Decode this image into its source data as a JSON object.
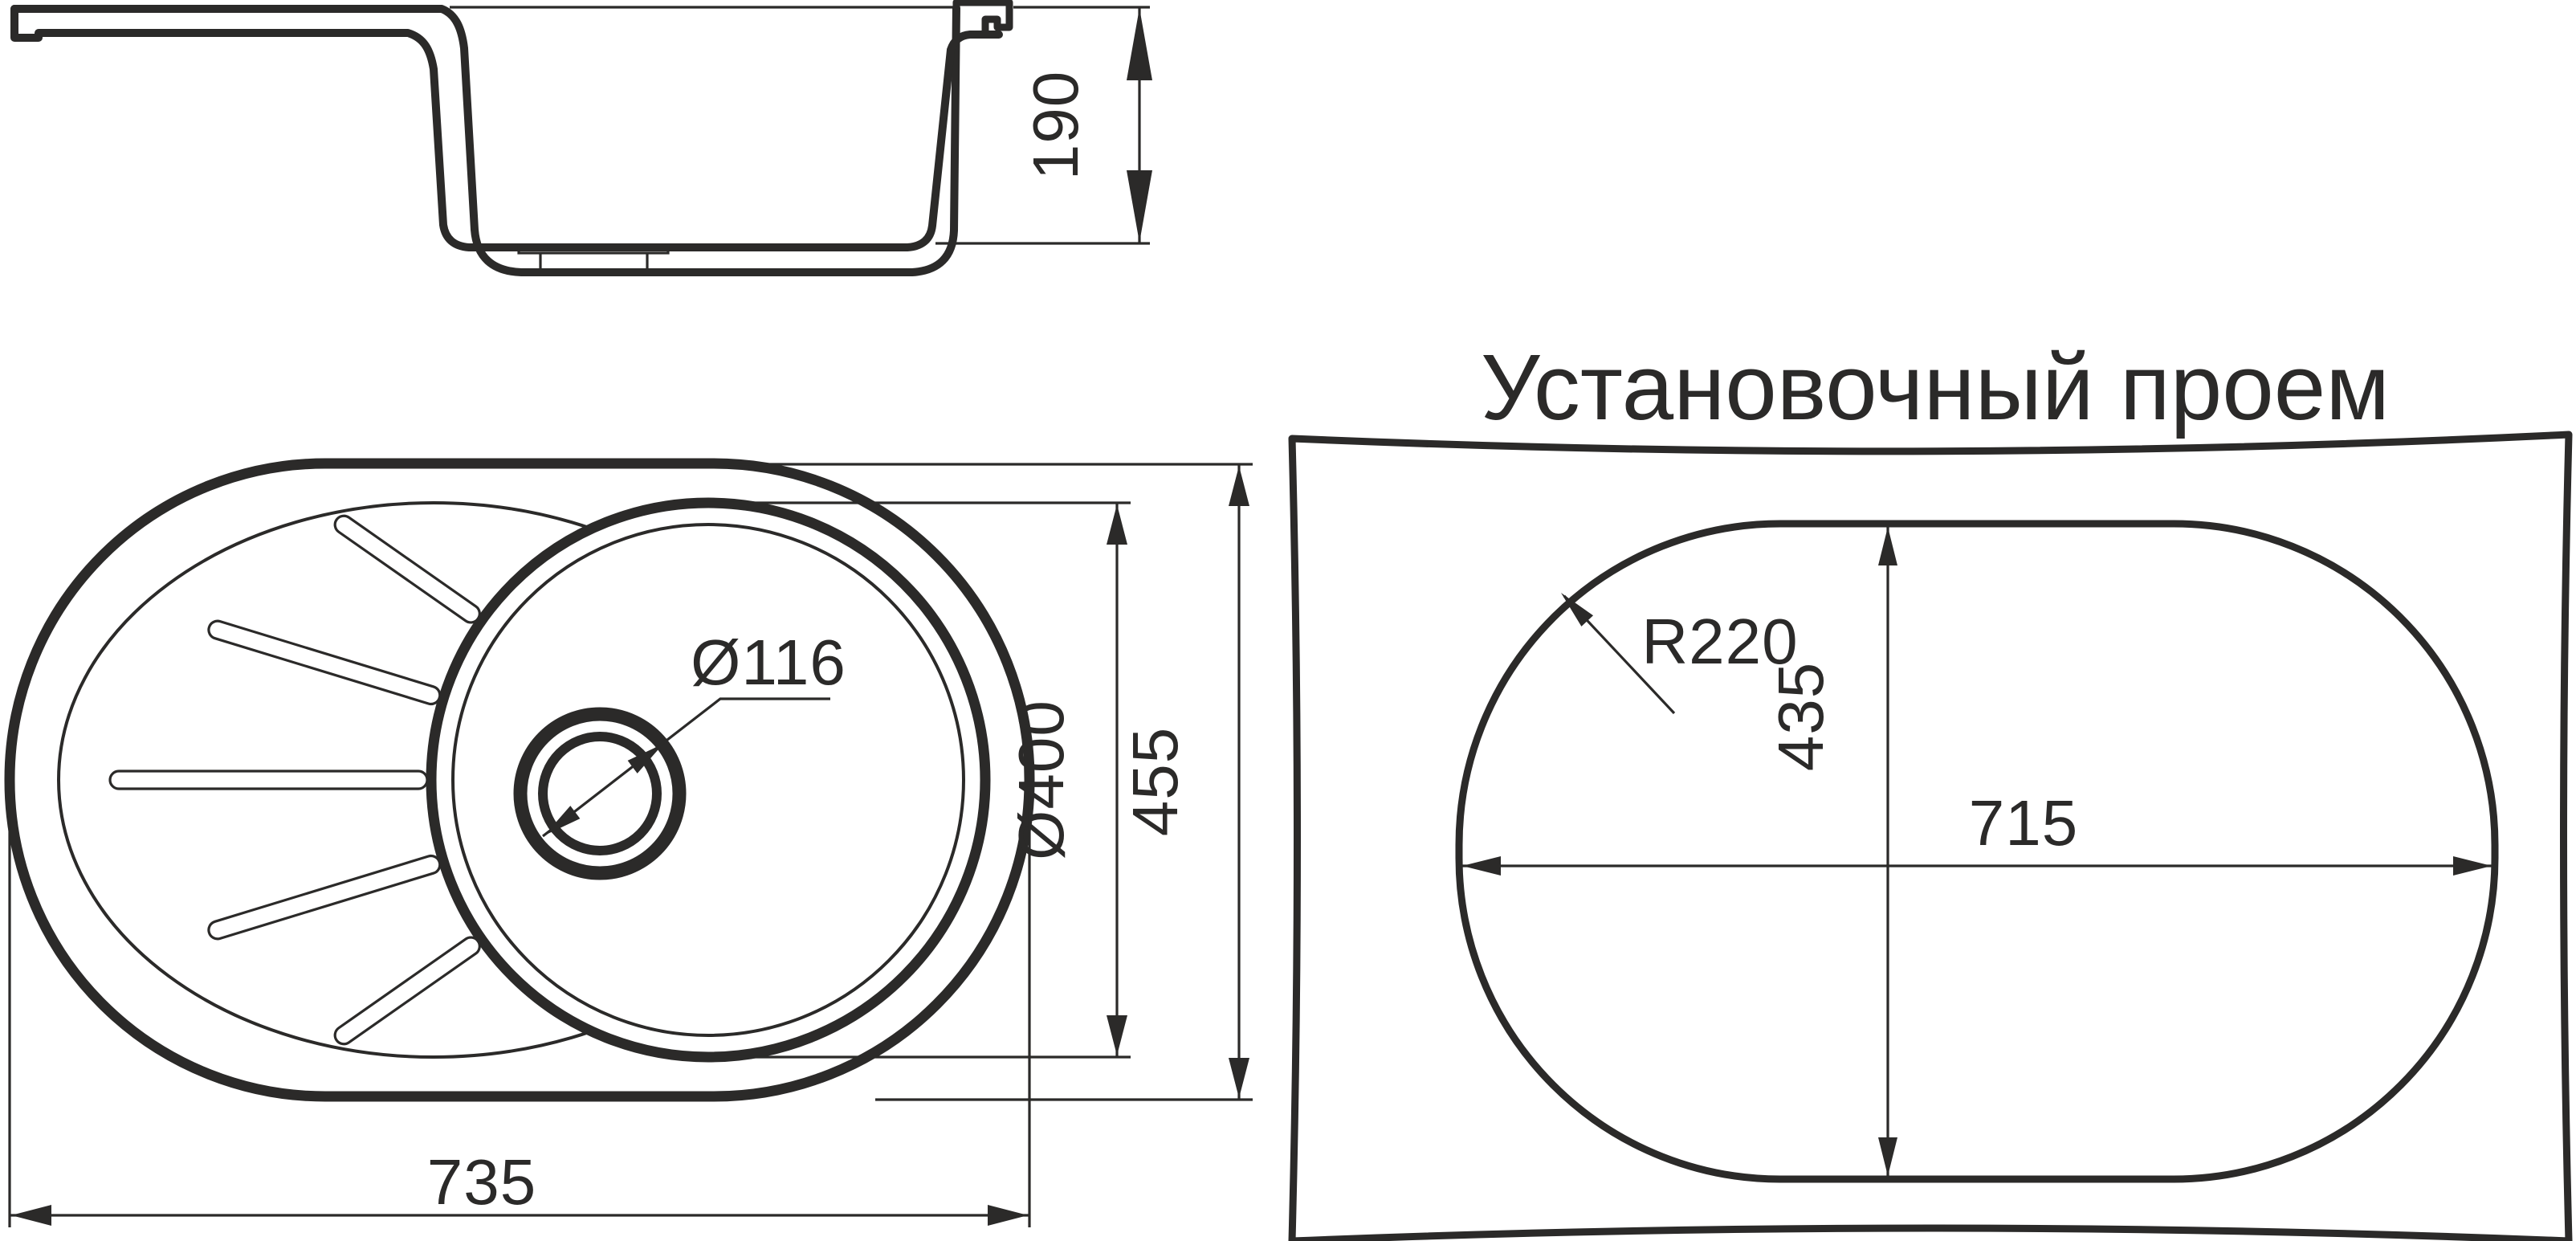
{
  "page": {
    "background": "#ffffff",
    "ink_color": "#2b2a29"
  },
  "side_view": {
    "depth": "190"
  },
  "top_view": {
    "drain_diameter": "Ø116",
    "bowl_diameter": "Ø400",
    "overall_depth": "455",
    "overall_width": "735"
  },
  "opening_view": {
    "title": "Установочный проем",
    "corner_radius": "R220",
    "height": "435",
    "width": "715"
  }
}
